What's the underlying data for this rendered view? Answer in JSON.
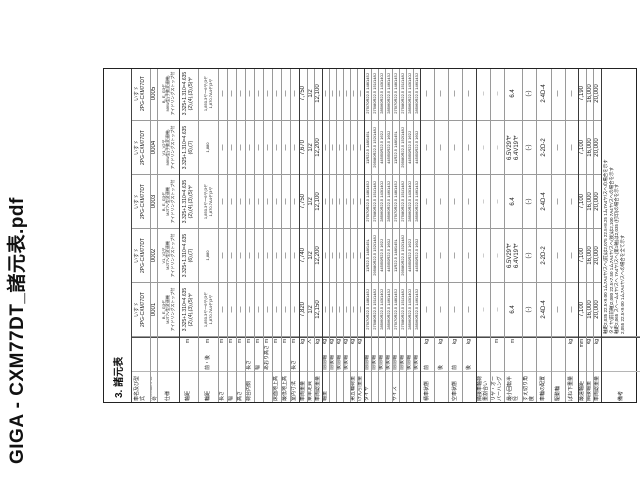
{
  "viewer": {
    "file_title": "GIGA - CXM77DT_諸元表.pdf"
  },
  "page": {
    "caption": "3. 諸元表"
  },
  "table": {
    "column_class_numbers": [
      "0001",
      "0002",
      "0003",
      "0004",
      "0005"
    ],
    "rows": [
      {
        "label": "車名及び型式",
        "sub": "",
        "unit": "",
        "h": 18,
        "cls": "sm",
        "cells": [
          [
            "いすゞ",
            "2PG-CXM77DT"
          ],
          [
            "いすゞ",
            "2PG-CXM77DT"
          ],
          [
            "いすゞ",
            "2PG-CXM77DT"
          ],
          [
            "いすゞ",
            "2PG-CXM77DT"
          ],
          [
            "いすゞ",
            "2PG-CXM77DT"
          ]
        ]
      },
      {
        "label": "類別区分番号",
        "sub": "",
        "unit": "",
        "h": 7,
        "cells": [
          [
            "0001"
          ],
          [
            "0002"
          ],
          [
            "0003"
          ],
          [
            "0004"
          ],
          [
            "0005"
          ]
        ]
      },
      {
        "label": "仕様",
        "sub": "",
        "unit": "",
        "h": 22,
        "cls": "tiny",
        "cells": [
          [
            "B, E, G3ヤ",
            "MJT7V型変速機",
            "アイドリングストップ付"
          ],
          [
            "V1, V2ヤ",
            "MJT7V型変速機",
            "アイドリングストップ付"
          ],
          [
            "B, E, G3ヤ",
            "MJT7V型変速機",
            "アイドリングストップ付"
          ],
          [
            "V1, V2ヤ",
            "M6W型(手動変速機)",
            "アイドリングストップ付"
          ],
          [
            "B, E, G3ヤ",
            "M6W型(手動変速機)",
            "アイドリングストップ付"
          ]
        ]
      },
      {
        "label": "軸距",
        "sub": "",
        "unit": "m",
        "h": 19,
        "cls": "sm",
        "strong": true,
        "cells": [
          [
            "3.325+1.310=4.635",
            "(2),(4),(3),(5)ヤ"
          ],
          [
            "3.325+1.310=4.635",
            "(6),(7)"
          ],
          [
            "3.325+1.310=4.635",
            "(2),(4),(3),(5)ヤ"
          ],
          [
            "3.325+1.310=4.635",
            "(6),(7)"
          ],
          [
            "3.325+1.310=4.635",
            "(2),(4),(3),(5)ヤ"
          ]
        ]
      },
      {
        "label": "輪距",
        "sub": "前・後",
        "unit": "m",
        "h": 20,
        "cls": "tiny",
        "cells": [
          [
            "1,850.3ヤ〜6ヤ(3ヤ",
            "1,870.7A4ヤ(3ヤ"
          ],
          [
            "1,880"
          ],
          [
            "1,850.3ヤ〜6ヤ(3ヤ",
            "1,870.7A4ヤ(3ヤ"
          ],
          [
            "1,880"
          ],
          [
            "1,850.3ヤ〜6ヤ(3ヤ",
            "1,870.7A4ヤ(3ヤ"
          ]
        ]
      },
      {
        "label": "長さ",
        "sub": "",
        "unit": "m",
        "h": 9,
        "cells": [
          [
            "—"
          ],
          [
            "—"
          ],
          [
            "—"
          ],
          [
            "—"
          ],
          [
            "—"
          ]
        ]
      },
      {
        "label": "幅",
        "sub": "",
        "unit": "m",
        "h": 9,
        "cells": [
          [
            "—"
          ],
          [
            "—"
          ],
          [
            "—"
          ],
          [
            "—"
          ],
          [
            "—"
          ]
        ]
      },
      {
        "label": "高さ",
        "sub": "",
        "unit": "m",
        "h": 9,
        "cells": [
          [
            "—"
          ],
          [
            "—"
          ],
          [
            "—"
          ],
          [
            "—"
          ],
          [
            "—"
          ]
        ]
      },
      {
        "label": "荷台内側",
        "sub": "長さ",
        "unit": "m",
        "h": 9,
        "cells": [
          [
            "—"
          ],
          [
            "—"
          ],
          [
            "—"
          ],
          [
            "—"
          ],
          [
            "—"
          ]
        ]
      },
      {
        "label": "",
        "sub": "幅",
        "unit": "m",
        "h": 9,
        "cells": [
          [
            "—"
          ],
          [
            "—"
          ],
          [
            "—"
          ],
          [
            "—"
          ],
          [
            "—"
          ]
        ]
      },
      {
        "label": "",
        "sub": "あおり高さ",
        "unit": "m",
        "h": 9,
        "cells": [
          [
            "—"
          ],
          [
            "—"
          ],
          [
            "—"
          ],
          [
            "—"
          ],
          [
            "—"
          ]
        ]
      },
      {
        "label": "床面地上高",
        "sub": "",
        "unit": "m",
        "h": 9,
        "cells": [
          [
            "—"
          ],
          [
            "—"
          ],
          [
            "—"
          ],
          [
            "—"
          ],
          [
            "—"
          ]
        ]
      },
      {
        "label": "最低地上高",
        "sub": "",
        "unit": "m",
        "h": 9,
        "cells": [
          [
            "—"
          ],
          [
            "—"
          ],
          [
            "—"
          ],
          [
            "—"
          ],
          [
            "—"
          ]
        ]
      },
      {
        "label": "室内寸法",
        "sub": "長さ",
        "unit": "m",
        "h": 9,
        "cells": [
          [
            "—"
          ],
          [
            "—"
          ],
          [
            "—"
          ],
          [
            "—"
          ],
          [
            "—"
          ]
        ]
      },
      {
        "label": "車両重量",
        "sub": "",
        "unit": "kg",
        "h": 8,
        "strong": true,
        "cells": [
          [
            "7,820"
          ],
          [
            "7,740"
          ],
          [
            "7,750"
          ],
          [
            "7,670"
          ],
          [
            "7,750"
          ]
        ]
      },
      {
        "label": "乗車定員",
        "sub": "",
        "unit": "人",
        "h": 7,
        "cells": [
          [
            "1/2"
          ],
          [
            "1/2"
          ],
          [
            "1/2"
          ],
          [
            "1/2"
          ],
          [
            "1/2"
          ]
        ]
      },
      {
        "label": "車両総重量",
        "sub": "",
        "unit": "kg",
        "h": 8,
        "cells": [
          [
            "12,150"
          ],
          [
            "12,200"
          ],
          [
            "12,100"
          ],
          [
            "12,200"
          ],
          [
            "12,100"
          ]
        ]
      },
      {
        "label": "軸重",
        "sub": "前前軸",
        "unit": "kg",
        "h": 7,
        "strong": true,
        "cells": [
          [
            "—"
          ],
          [
            "—"
          ],
          [
            "—"
          ],
          [
            "—"
          ],
          [
            "—"
          ]
        ]
      },
      {
        "label": "",
        "sub": "前後軸",
        "unit": "kg",
        "h": 7,
        "cells": [
          [
            "—"
          ],
          [
            "—"
          ],
          [
            "—"
          ],
          [
            "—"
          ],
          [
            "—"
          ]
        ]
      },
      {
        "label": "",
        "sub": "後前軸",
        "unit": "kg",
        "h": 7,
        "cells": [
          [
            "—"
          ],
          [
            "—"
          ],
          [
            "—"
          ],
          [
            "—"
          ],
          [
            "—"
          ]
        ]
      },
      {
        "label": "",
        "sub": "後後軸",
        "unit": "kg",
        "h": 7,
        "cells": [
          [
            "—"
          ],
          [
            "—"
          ],
          [
            "—"
          ],
          [
            "—"
          ],
          [
            "—"
          ]
        ]
      },
      {
        "label": "第五輪荷重",
        "sub": "",
        "unit": "kg",
        "h": 7,
        "cells": [
          [
            "—"
          ],
          [
            "—"
          ],
          [
            "—"
          ],
          [
            "—"
          ],
          [
            "—"
          ]
        ]
      },
      {
        "label": "けん引重量",
        "sub": "",
        "unit": "kg",
        "h": 7,
        "cells": [
          [
            "—"
          ],
          [
            "—"
          ],
          [
            "—"
          ],
          [
            "—"
          ],
          [
            "—"
          ]
        ]
      },
      {
        "label": "タイヤ",
        "sub": "前前軸",
        "unit": "",
        "h": 7,
        "cls": "tiny",
        "strong": true,
        "cells": [
          [
            "275/70R22.5 148/145J"
          ],
          [
            "11R22.5 148/145L"
          ],
          [
            "275/70R22.5 148/145J"
          ],
          [
            "11R22.5 148/145L"
          ],
          [
            "275/70R22.5 148/145J"
          ]
        ]
      },
      {
        "label": "",
        "sub": "前後軸",
        "unit": "",
        "h": 7,
        "cls": "tiny",
        "cells": [
          [
            "275/80R22.5 151/148J"
          ],
          [
            "295/80R22.5 152/148J"
          ],
          [
            "275/80R22.5 151/148J"
          ],
          [
            "295/80R22.5 152/148J"
          ],
          [
            "275/80R22.5 151/148J"
          ]
        ]
      },
      {
        "label": "",
        "sub": "後前軸",
        "unit": "",
        "h": 7,
        "cls": "tiny",
        "cells": [
          [
            "285/60R22.5 143/140J"
          ],
          [
            "445/50R22.5 162J"
          ],
          [
            "285/60R22.5 143/140J"
          ],
          [
            "445/50R22.5 162J"
          ],
          [
            "285/60R22.5 143/140J"
          ]
        ]
      },
      {
        "label": "",
        "sub": "後後軸",
        "unit": "",
        "h": 7,
        "cls": "tiny",
        "cells": [
          [
            "285/60R22.5 146/143J"
          ],
          [
            "445/50R22.5 160J"
          ],
          [
            "285/60R22.5 146/143J"
          ],
          [
            "445/50R22.5 160J"
          ],
          [
            "285/60R22.5 146/143J"
          ]
        ]
      },
      {
        "label": "サイズ",
        "sub": "前前軸",
        "unit": "",
        "h": 7,
        "cls": "tiny",
        "cells": [
          [
            "275/70R22.5 148/145J"
          ],
          [
            "11R22.5 148/145L"
          ],
          [
            "275/70R22.5 148/145J"
          ],
          [
            "11R22.5 148/145L"
          ],
          [
            "275/70R22.5 148/145J"
          ]
        ]
      },
      {
        "label": "",
        "sub": "前後軸",
        "unit": "",
        "h": 7,
        "cls": "tiny",
        "cells": [
          [
            "275/80R22.5 151/148J"
          ],
          [
            "295/80R22.5 152/148J"
          ],
          [
            "275/80R22.5 151/148J"
          ],
          [
            "295/80R22.5 152/148J"
          ],
          [
            "275/80R22.5 151/148J"
          ]
        ]
      },
      {
        "label": "",
        "sub": "後前軸",
        "unit": "",
        "h": 7,
        "cls": "tiny",
        "cells": [
          [
            "285/60R22.5 143/140J"
          ],
          [
            "445/50R22.5 162J"
          ],
          [
            "285/60R22.5 143/140J"
          ],
          [
            "445/50R22.5 162J"
          ],
          [
            "285/60R22.5 143/140J"
          ]
        ]
      },
      {
        "label": "",
        "sub": "後後軸",
        "unit": "",
        "h": 7,
        "cls": "tiny",
        "cells": [
          [
            "285/60R22.5 146/143J"
          ],
          [
            "445/50R22.5 160J"
          ],
          [
            "285/60R22.5 146/143J"
          ],
          [
            "445/50R22.5 160J"
          ],
          [
            "285/60R22.5 146/143J"
          ]
        ]
      },
      {
        "label": "積車状態",
        "sub": "前",
        "unit": "kg",
        "h": 14,
        "strong": true,
        "cells": [
          [
            "—"
          ],
          [
            "—"
          ],
          [
            "—"
          ],
          [
            "—"
          ],
          [
            "—"
          ]
        ]
      },
      {
        "label": "",
        "sub": "後",
        "unit": "kg",
        "h": 14,
        "cells": [
          [
            "—"
          ],
          [
            "—"
          ],
          [
            "—"
          ],
          [
            "—"
          ],
          [
            "—"
          ]
        ]
      },
      {
        "label": "空車状態",
        "sub": "前",
        "unit": "kg",
        "h": 14,
        "cells": [
          [
            "—"
          ],
          [
            "—"
          ],
          [
            "—"
          ],
          [
            "—"
          ],
          [
            "—"
          ]
        ]
      },
      {
        "label": "",
        "sub": "後",
        "unit": "kg",
        "h": 14,
        "cells": [
          [
            "—"
          ],
          [
            "—"
          ],
          [
            "—"
          ],
          [
            "—"
          ],
          [
            "—"
          ]
        ]
      },
      {
        "label": "隣接車軸荷重割合い",
        "sub": "",
        "unit": "",
        "h": 14,
        "cls": "tiny",
        "strong": true,
        "cells": [
          [
            "—"
          ],
          [
            "—"
          ],
          [
            "—"
          ],
          [
            "—"
          ],
          [
            "—"
          ]
        ]
      },
      {
        "label": "リヤ・オーバーハング",
        "sub": "",
        "unit": "m",
        "h": 14,
        "cls": "tiny",
        "cells": [
          [
            "—"
          ],
          [
            "—"
          ],
          [
            "—"
          ],
          [
            "—"
          ],
          [
            "—"
          ]
        ]
      },
      {
        "label": "最小回転半径",
        "sub": "",
        "unit": "m",
        "h": 18,
        "cells": [
          [
            "6.4"
          ],
          [
            "6.5V29ヤ",
            "6.4V19ヤ"
          ],
          [
            "6.4"
          ],
          [
            "6.5V29ヤ",
            "6.4V19ヤ"
          ],
          [
            "6.4"
          ]
        ]
      },
      {
        "label": "すえ切り角度",
        "sub": "",
        "unit": "",
        "h": 14,
        "cells": [
          [
            "(-)"
          ],
          [
            "(-)"
          ],
          [
            "(-)"
          ],
          [
            "(-)"
          ],
          [
            "(-)"
          ]
        ]
      },
      {
        "label": "車輪の配置",
        "sub": "",
        "unit": "",
        "h": 15,
        "cells": [
          [
            "2-4D-4"
          ],
          [
            "2-2D-2"
          ],
          [
            "2-4D-4"
          ],
          [
            "2-2D-2"
          ],
          [
            "2-4D-4"
          ]
        ]
      },
      {
        "label": "駆動輪",
        "sub": "",
        "unit": "",
        "h": 14,
        "cells": [
          [
            "—"
          ],
          [
            "—"
          ],
          [
            "—"
          ],
          [
            "—"
          ],
          [
            "—"
          ]
        ]
      },
      {
        "label": "ばね下重量",
        "sub": "",
        "unit": "kg",
        "h": 13,
        "cells": [
          [
            "—"
          ],
          [
            "—"
          ],
          [
            "—"
          ],
          [
            "—"
          ],
          [
            "—"
          ]
        ]
      },
      {
        "label": "最遠軸距",
        "sub": "",
        "unit": "mm",
        "h": 8,
        "strong": true,
        "cells": [
          [
            "7,100"
          ],
          [
            "7,100"
          ],
          [
            "7,100"
          ],
          [
            "7,100"
          ],
          [
            "7,190"
          ]
        ]
      },
      {
        "label": "隣接軸重",
        "sub": "",
        "unit": "kg",
        "h": 7,
        "cells": [
          [
            "16,000"
          ],
          [
            "16,000"
          ],
          [
            "16,000"
          ],
          [
            "16,000"
          ],
          [
            "16,000"
          ]
        ]
      },
      {
        "label": "車両総重量",
        "sub": "",
        "unit": "kg",
        "h": 8,
        "cells": [
          [
            "20,000"
          ],
          [
            "20,000"
          ],
          [
            "20,000"
          ],
          [
            "20,000"
          ],
          [
            "20,000"
          ]
        ]
      },
      {
        "label": "備考",
        "sub": "",
        "unit": "",
        "h": 41,
        "strong": true,
        "span": true,
        "cells": [
          [
            "軸距2,035 22.5×9.00 1ム7A4ヤ/スヘ(前)は2,075 22.5×8.25 1ム7A4ヤ/スヘの場合を示す",
            "タイヤ(前前軸)2,080 22.5×7.50 1ム7A4ヤ/スヘ(後)は2,100 7A4ヤ/スヘの場合を示す",
            "軸距2,065 スヘーム4ヤ/スヘ 7A4ヤ/スヘ(第1軸)は2,035 (打印)の場合を示す",
            "2,055 22.5×9.00 1ム7A4ヤ/スヘの場合を全て示す"
          ]
        ]
      }
    ]
  }
}
